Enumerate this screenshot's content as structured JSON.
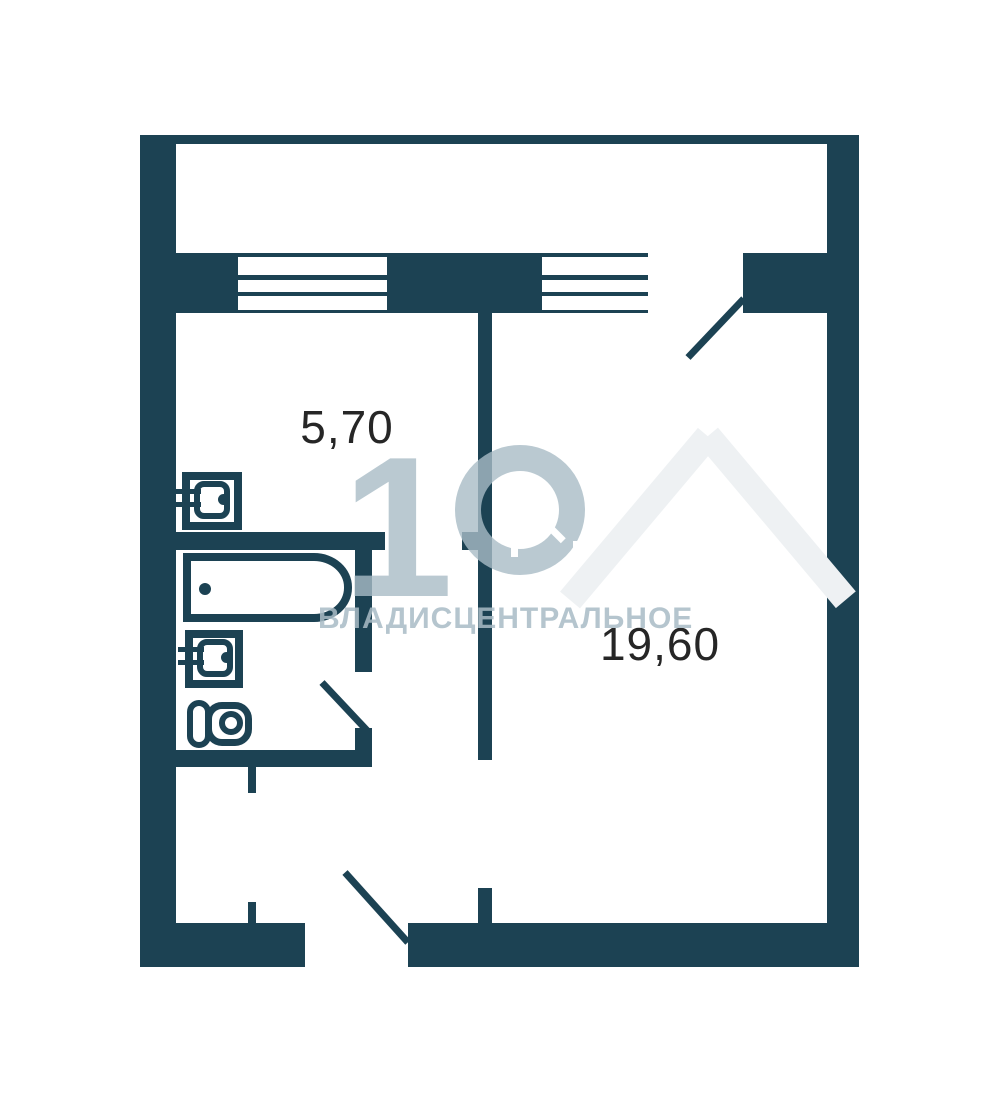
{
  "canvas": {
    "width": 991,
    "height": 1101
  },
  "colors": {
    "wall": "#1c4253",
    "background": "#ffffff",
    "label": "#262626",
    "watermark": "#a9bcc6",
    "watermark_faint": "#eef1f3"
  },
  "rooms": {
    "kitchen": {
      "area_label": "5,70"
    },
    "living_room": {
      "area_label": "19,60"
    }
  },
  "watermark": {
    "numeral": "1",
    "text": "ВЛАДИСЦЕНТРАЛЬНОЕ"
  },
  "fixtures": [
    "kitchen-sink",
    "bathtub",
    "bathroom-sink",
    "toilet"
  ],
  "openings": [
    "balcony-door",
    "bathroom-door",
    "entrance-door",
    "room-doorway",
    "closet-opening",
    "kitchen-doorway"
  ],
  "windows": [
    "balcony-window-left",
    "balcony-window-right"
  ]
}
